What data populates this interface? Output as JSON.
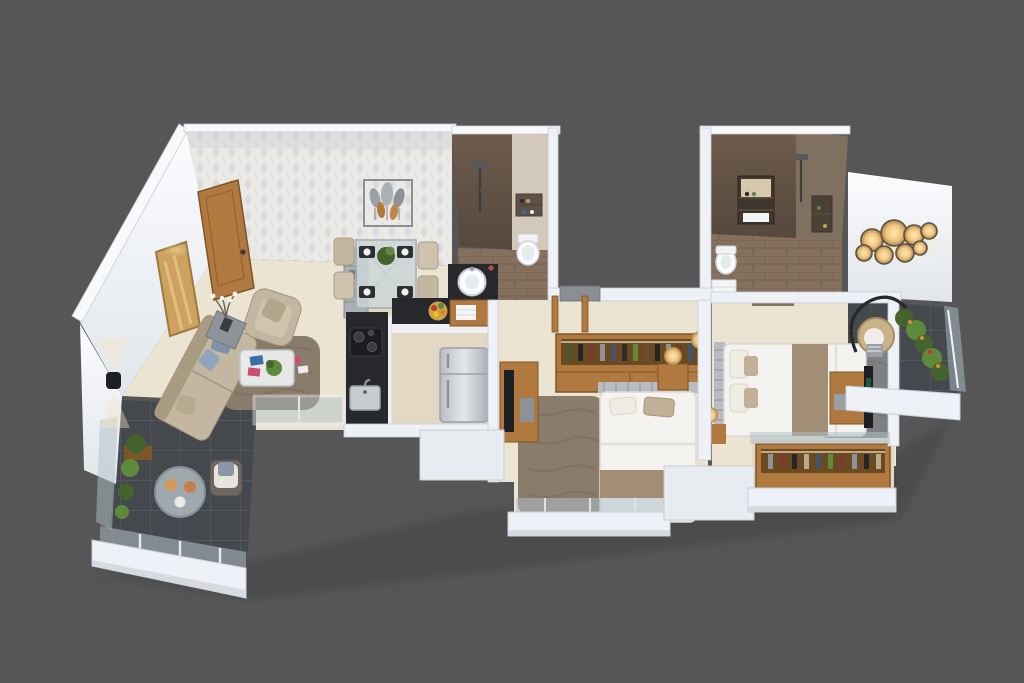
{
  "scene": {
    "description": "3D isometric dollhouse render of a 2-bedroom apartment floor plan on a plain dark gray background, no text or labels visible",
    "view": "top-down perspective cutaway",
    "rooms": [
      {
        "name": "living-room",
        "items": [
          "entrance-door",
          "wallpaper-accent-wall",
          "wall-art",
          "sofa",
          "armchair",
          "side-table-with-vase",
          "coffee-table",
          "shag-rug",
          "shelf-unit",
          "sliding-glass-door"
        ]
      },
      {
        "name": "dining-area",
        "items": [
          "glass-dining-table",
          "four-beige-chairs",
          "place-settings",
          "potted-plant-centerpiece",
          "leaf-wall-art"
        ]
      },
      {
        "name": "kitchen",
        "items": [
          "black-granite-counter",
          "gas-hob",
          "sink",
          "upper-counter-with-fruit-bowl",
          "refrigerator"
        ]
      },
      {
        "name": "common-bathroom",
        "items": [
          "dark-tile-shower-wall",
          "shower-set",
          "niche-shelf",
          "wall-hung-toilet",
          "round-wash-basin",
          "wood-vanity-with-towel"
        ]
      },
      {
        "name": "bedroom-1",
        "items": [
          "open-wardrobe-with-clothes",
          "double-bed",
          "pillows",
          "bed-runner",
          "shag-rug",
          "tv-unit",
          "bedside-lamp",
          "glass-juliet-railing"
        ]
      },
      {
        "name": "master-bedroom",
        "items": [
          "double-bed",
          "pillows",
          "bed-runner",
          "gray-shag-rug",
          "tv-unit",
          "open-wardrobe-with-clothes",
          "glowing-floor-lamps",
          "glass-juliet-railing"
        ]
      },
      {
        "name": "master-bathroom",
        "items": [
          "brown-tile-walls",
          "lit-niche-shelf",
          "shower-set",
          "side-niche",
          "toilet",
          "small-vanity"
        ]
      },
      {
        "name": "living-balcony",
        "items": [
          "dark-tile-floor",
          "glass-railing",
          "planters",
          "round-glass-table-with-snacks",
          "chair",
          "exterior-wall-sconce"
        ]
      },
      {
        "name": "master-balcony",
        "items": [
          "hanging-egg-chair",
          "plant-row",
          "glass-railing-with-light-strip",
          "dark-tile-floor"
        ]
      },
      {
        "name": "exterior",
        "items": [
          "bubble-wall-light-cluster",
          "white-parapet-fascias"
        ]
      }
    ]
  },
  "colors": {
    "background": "#565656",
    "wall_white": "#f0f3f7",
    "wall_bright": "#fafbfd",
    "wall_shade": "#d6dbe2",
    "floor_cream": "#ece4d3",
    "floor_cream_dark": "#e2d8c4",
    "balcony_tile": "#45484c",
    "bath_wall_dark": "#64554a",
    "bath_wall_light": "#80705f",
    "bath_floor": "#84705d",
    "bath_beige": "#d2c9bb",
    "wood": "#b0793f",
    "wood_dark": "#7e5526",
    "wood_interior": "#6b4a22",
    "counter_black": "#26282b",
    "steel": "#c7cbd0",
    "sofa_beige": "#c4b7a1",
    "sofa_dark": "#a99a82",
    "cushion_blue": "#7e93a8",
    "rug_brown": "#8a7c6a",
    "rug_gray": "#7e8082",
    "bed_white": "#f4f3ef",
    "bed_runner": "#a18e75",
    "headboard_silver": "#b9bcc0",
    "plant_green": "#45632f",
    "plant_light": "#5f8a3c",
    "glass": "#aebfc7",
    "lamp_glow": "#f7d9a4",
    "tv_black": "#1d1f22",
    "art_gold": "#cda15f"
  }
}
